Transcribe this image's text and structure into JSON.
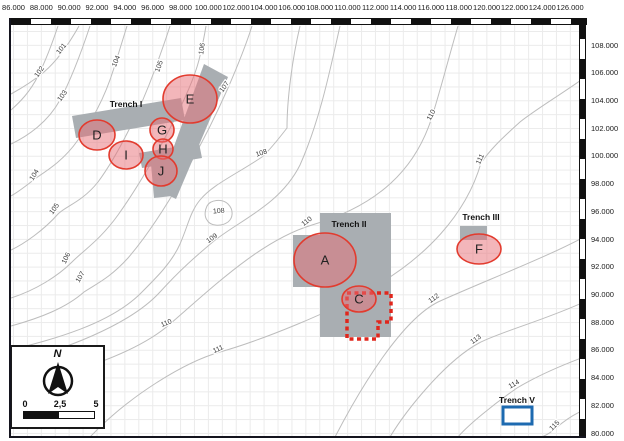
{
  "axes": {
    "top_ticks": [
      "86.000",
      "88.000",
      "90.000",
      "92.000",
      "94.000",
      "96.000",
      "98.000",
      "100.000",
      "102.000",
      "104.000",
      "106.000",
      "108.000",
      "110.000",
      "112.000",
      "114.000",
      "116.000",
      "118.000",
      "120.000",
      "122.000",
      "124.000",
      "126.000"
    ],
    "right_ticks": [
      "108.000",
      "106.000",
      "104.000",
      "102.000",
      "100.000",
      "98.000",
      "96.000",
      "94.000",
      "92.000",
      "90.000",
      "88.000",
      "86.000",
      "84.000",
      "82.000",
      "80.000"
    ]
  },
  "trenches": [
    {
      "name": "Trench I"
    },
    {
      "name": "Trench II"
    },
    {
      "name": "Trench III"
    },
    {
      "name": "Trench V"
    }
  ],
  "features": [
    {
      "label": "D",
      "cx": 97,
      "cy": 135,
      "rx": 18,
      "ry": 15
    },
    {
      "label": "E",
      "cx": 190,
      "cy": 99,
      "rx": 27,
      "ry": 24
    },
    {
      "label": "G",
      "cx": 162,
      "cy": 130,
      "rx": 12,
      "ry": 12
    },
    {
      "label": "H",
      "cx": 163,
      "cy": 149,
      "rx": 10,
      "ry": 10
    },
    {
      "label": "I",
      "cx": 126,
      "cy": 155,
      "rx": 17,
      "ry": 14
    },
    {
      "label": "J",
      "cx": 161,
      "cy": 171,
      "rx": 16,
      "ry": 15
    },
    {
      "label": "A",
      "cx": 325,
      "cy": 260,
      "rx": 31,
      "ry": 27
    },
    {
      "label": "C",
      "cx": 359,
      "cy": 299,
      "rx": 17,
      "ry": 13
    },
    {
      "label": "F",
      "cx": 479,
      "cy": 249,
      "rx": 22,
      "ry": 15
    }
  ],
  "contour_labels": [
    {
      "t": "101",
      "x": 63,
      "y": 50,
      "r": -52
    },
    {
      "t": "102",
      "x": 41,
      "y": 73,
      "r": -55
    },
    {
      "t": "103",
      "x": 64,
      "y": 97,
      "r": -55
    },
    {
      "t": "104",
      "x": 118,
      "y": 62,
      "r": -68
    },
    {
      "t": "105",
      "x": 161,
      "y": 67,
      "r": -70
    },
    {
      "t": "106",
      "x": 204,
      "y": 49,
      "r": -82
    },
    {
      "t": "107",
      "x": 226,
      "y": 88,
      "r": -55
    },
    {
      "t": "104",
      "x": 36,
      "y": 176,
      "r": -58
    },
    {
      "t": "105",
      "x": 56,
      "y": 210,
      "r": -55
    },
    {
      "t": "106",
      "x": 68,
      "y": 259,
      "r": -65
    },
    {
      "t": "107",
      "x": 82,
      "y": 278,
      "r": -60
    },
    {
      "t": "108",
      "x": 262,
      "y": 155,
      "r": -18
    },
    {
      "t": "108",
      "x": 219,
      "y": 213,
      "r": -5
    },
    {
      "t": "109",
      "x": 213,
      "y": 240,
      "r": -35
    },
    {
      "t": "110",
      "x": 433,
      "y": 116,
      "r": -62
    },
    {
      "t": "110",
      "x": 308,
      "y": 223,
      "r": -38
    },
    {
      "t": "110",
      "x": 167,
      "y": 325,
      "r": -22
    },
    {
      "t": "111",
      "x": 482,
      "y": 160,
      "r": -65
    },
    {
      "t": "111",
      "x": 219,
      "y": 351,
      "r": -25
    },
    {
      "t": "112",
      "x": 435,
      "y": 300,
      "r": -35
    },
    {
      "t": "113",
      "x": 477,
      "y": 341,
      "r": -35
    },
    {
      "t": "114",
      "x": 515,
      "y": 386,
      "r": -30
    },
    {
      "t": "115",
      "x": 556,
      "y": 427,
      "r": -45
    }
  ],
  "legend": {
    "north": "N",
    "scale_ticks": [
      "0",
      "2,5",
      "5"
    ]
  },
  "colors": {
    "feature_fill": "rgba(232,110,118,0.5)",
    "feature_stroke": "#e23b2e",
    "trench_fill": "#a9aeb2",
    "dashed_outline": "#e0261c",
    "trench5_stroke": "#1d6ab0",
    "contour": "#bdbdbd"
  }
}
